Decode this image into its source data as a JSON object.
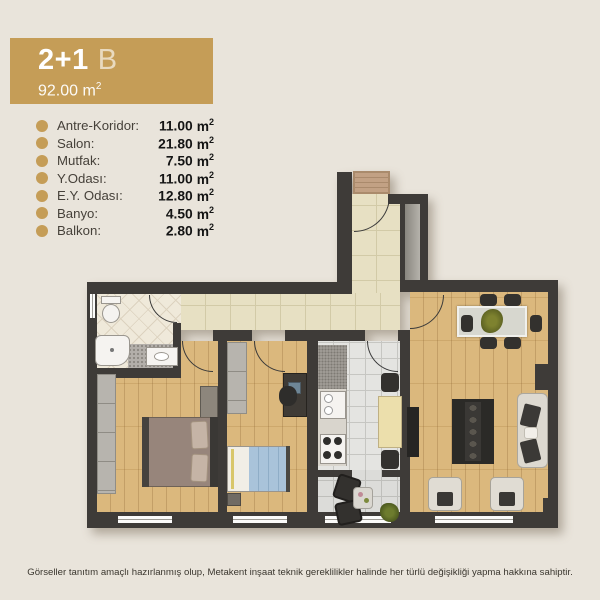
{
  "badge": {
    "type_label": "2+1",
    "variant_label": "B",
    "area_value": "92.00",
    "area_unit": "m",
    "area_unit_sup": "2"
  },
  "legend": {
    "items": [
      {
        "label": "Antre-Koridor:",
        "value": "11.00",
        "unit": "m",
        "sup": "2"
      },
      {
        "label": "Salon:",
        "value": "21.80",
        "unit": "m",
        "sup": "2"
      },
      {
        "label": "Mutfak:",
        "value": "7.50",
        "unit": "m",
        "sup": "2"
      },
      {
        "label": "Y.Odası:",
        "value": "11.00",
        "unit": "m",
        "sup": "2"
      },
      {
        "label": "E.Y. Odası:",
        "value": "12.80",
        "unit": "m",
        "sup": "2"
      },
      {
        "label": "Banyo:",
        "value": "4.50",
        "unit": "m",
        "sup": "2"
      },
      {
        "label": "Balkon:",
        "value": "2.80",
        "unit": "m",
        "sup": "2"
      }
    ]
  },
  "disclaimer": "Görseller tanıtım amaçlı hazırlanmış olup, Metakent inşaat teknik gereklilikler halinde her türlü değişikliği yapma hakkına sahiptir.",
  "colors": {
    "accent_gold": "#c59d57",
    "wall": "#3e3b38",
    "wood_floor": "#d9b476",
    "corridor_tile": "#e7e0c3",
    "kitchen_tile": "#e4e4e1",
    "background": "#e9e4db"
  }
}
